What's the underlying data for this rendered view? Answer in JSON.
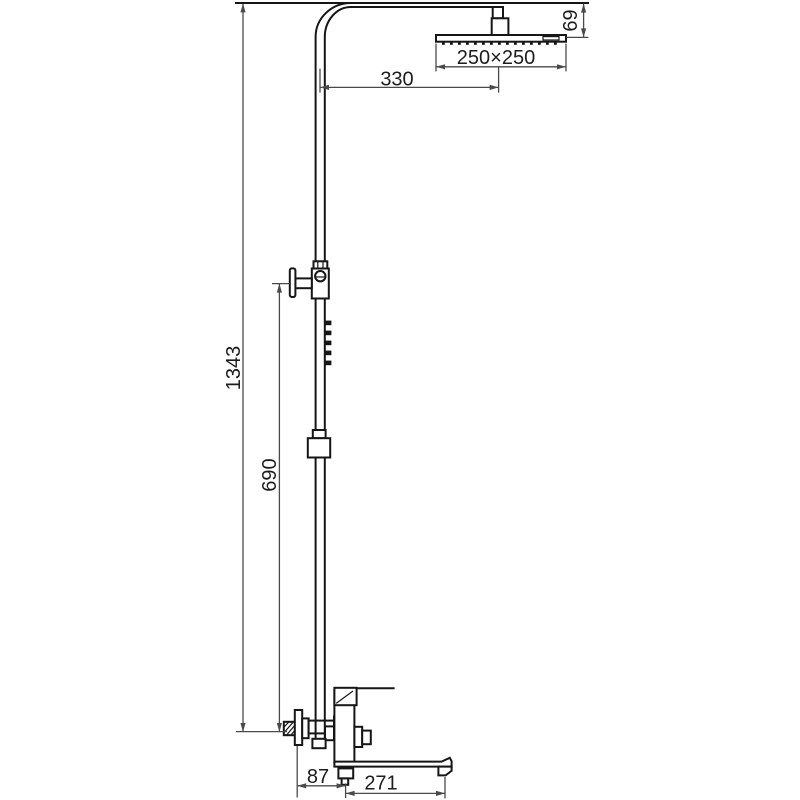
{
  "drawing": {
    "type": "technical-dimension-drawing",
    "subject": "shower column with square rain head and bath mixer",
    "background_color": "#ffffff",
    "line_color": "#161616",
    "dimension_color": "#4a4a4a",
    "dimensions_mm": {
      "overall_height": "1343",
      "riser_lower_height": "690",
      "arm_projection": "330",
      "head_size": "250×250",
      "head_height": "69",
      "wall_to_outlet": "87",
      "spout_projection": "271"
    }
  }
}
